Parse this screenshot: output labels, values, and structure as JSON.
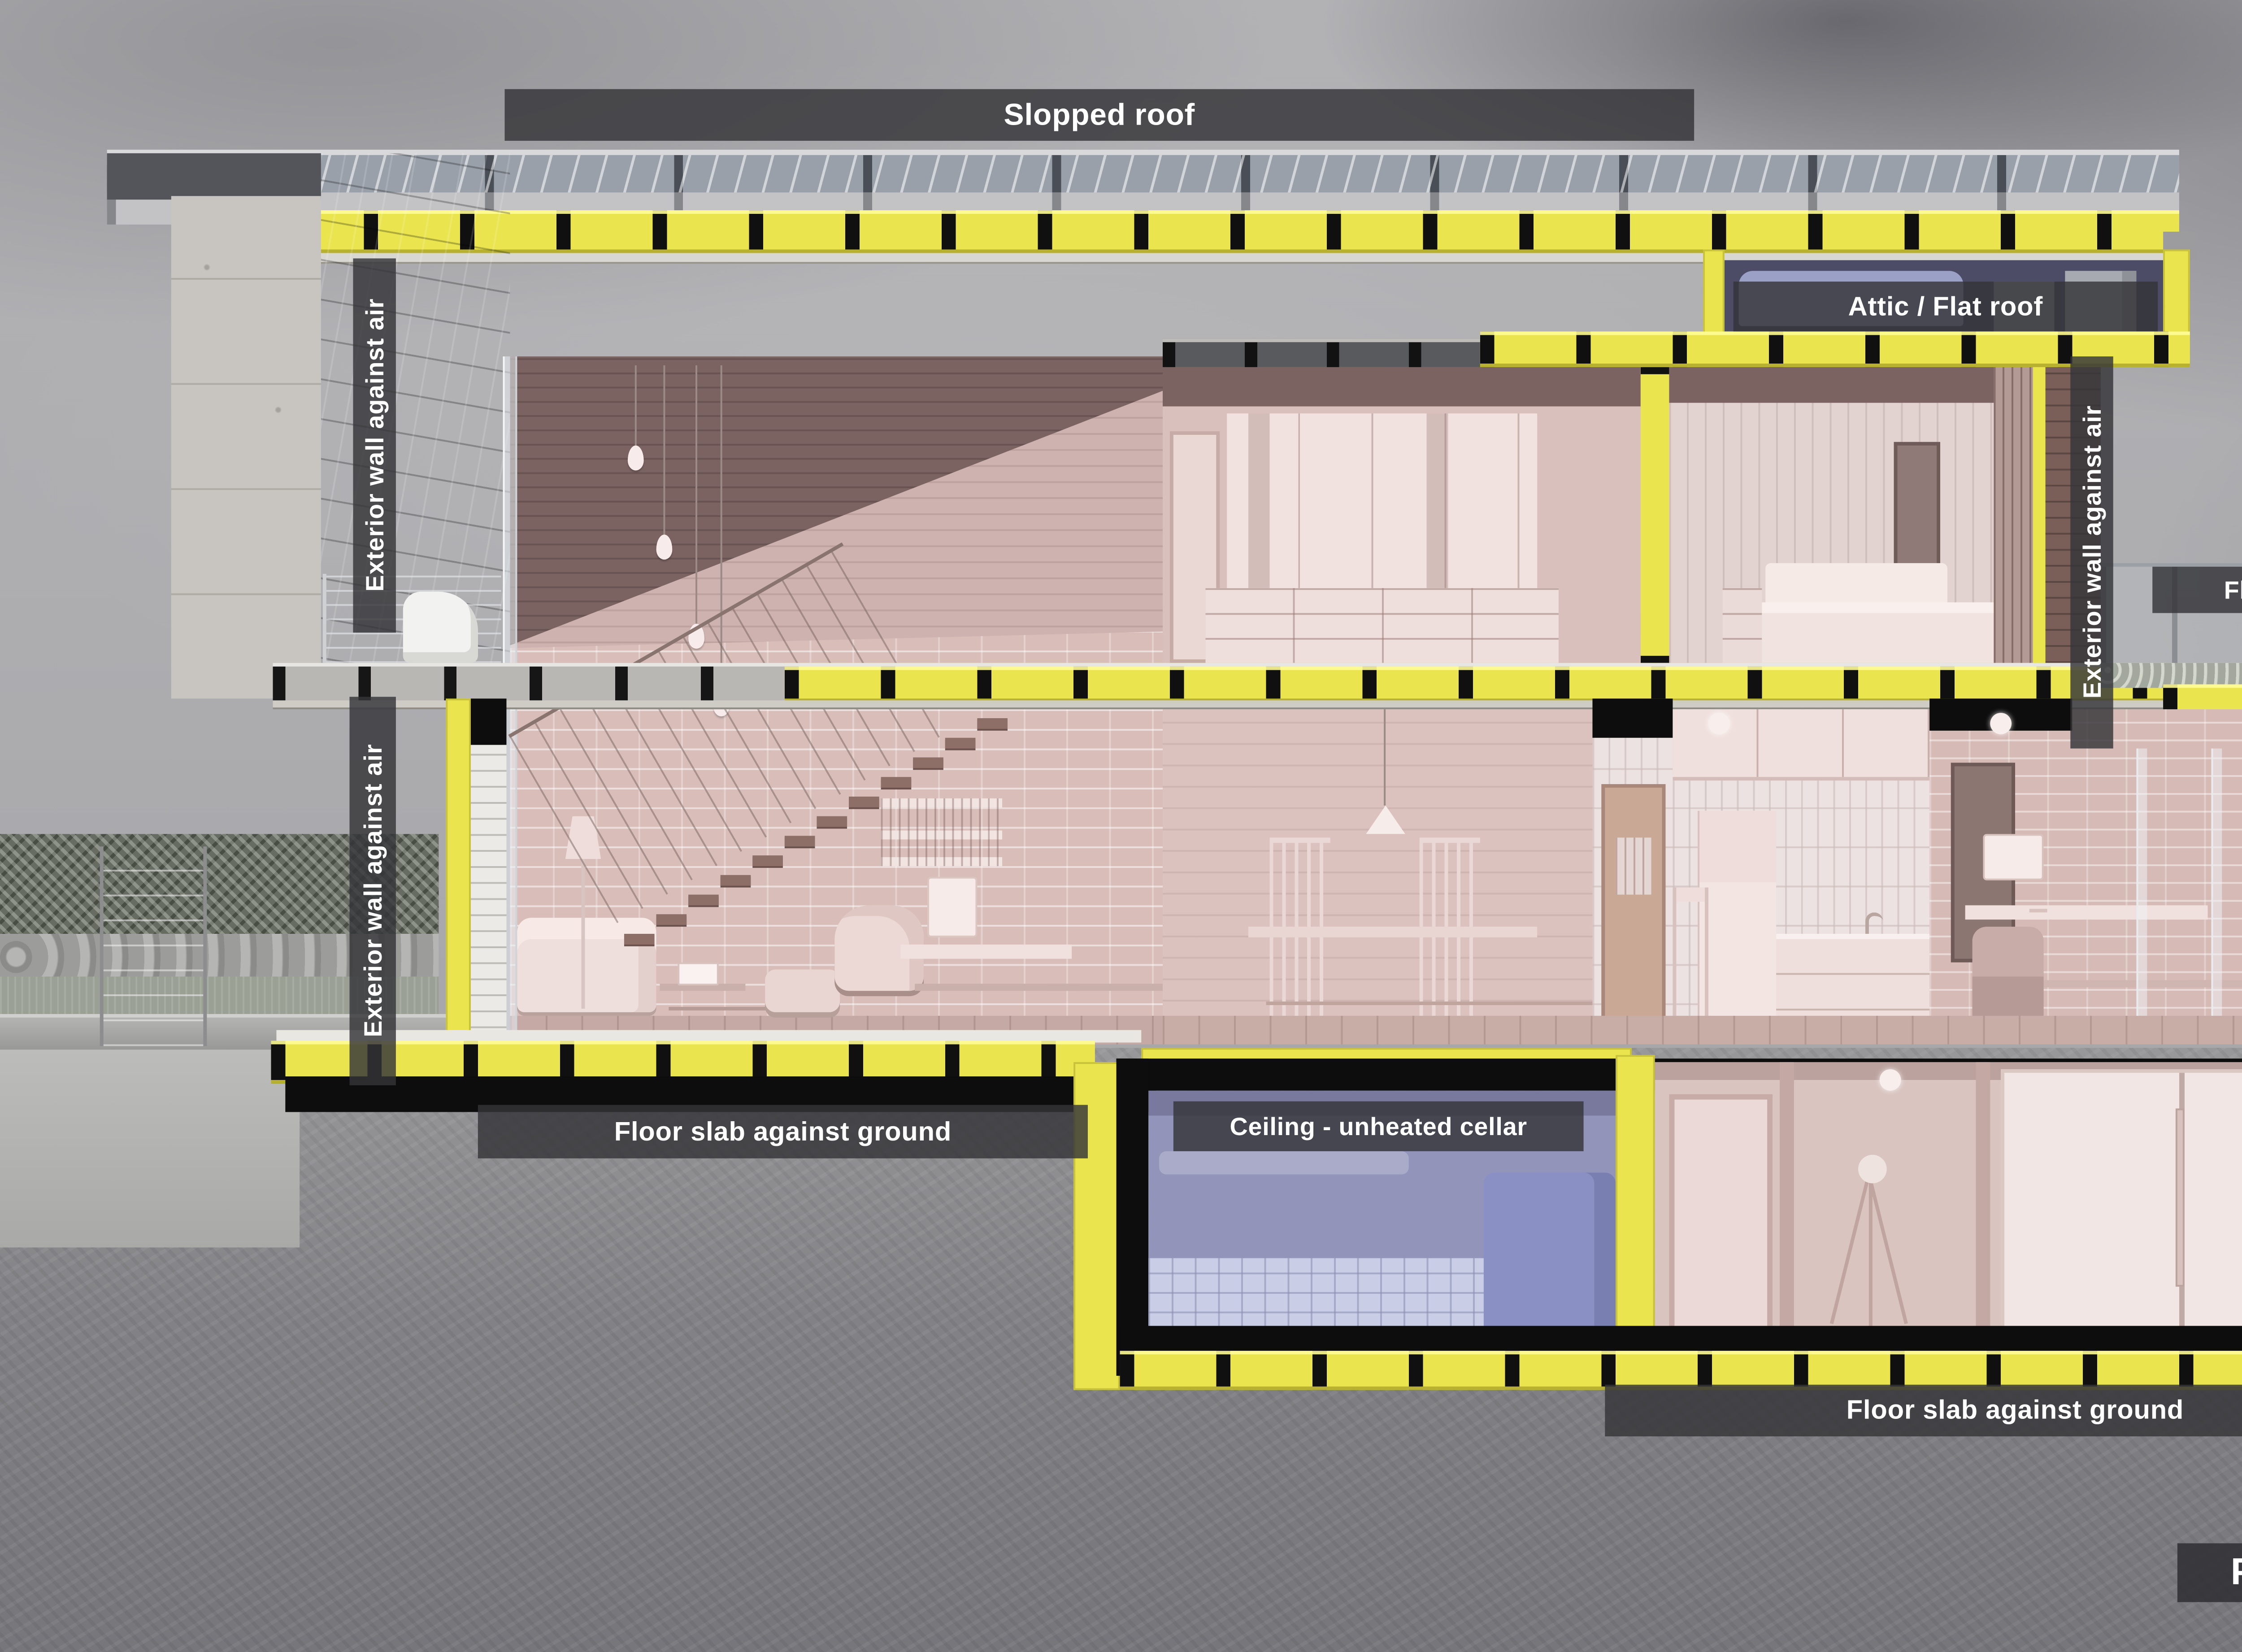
{
  "scene": {
    "title": "Passive House Components"
  },
  "component_labels": {
    "slopped_roof": "Slopped roof",
    "attic_flat_roof": "Attic / Flat roof",
    "flat_roof": "Flat roof",
    "exterior_wall_against_air": "Exterior wall against air",
    "exterior_wall_against_ground": "Exterior wall against ground",
    "floor_slab_against_ground": "Floor slab against ground",
    "ceiling_unheated_cellar": "Ceiling - unheated cellar"
  },
  "colors": {
    "insulation_yellow": "#eae44f",
    "structure_black": "#0d0d0d",
    "label_bar_gray": "#343438",
    "label_text": "#ffffff",
    "interior_pink": "#d8bdb9",
    "attic_blue": "#4c4c67",
    "unheated_cellar_blue": "#9294ba",
    "sky_gray": "#adadb0",
    "ground_gray": "#828286"
  }
}
